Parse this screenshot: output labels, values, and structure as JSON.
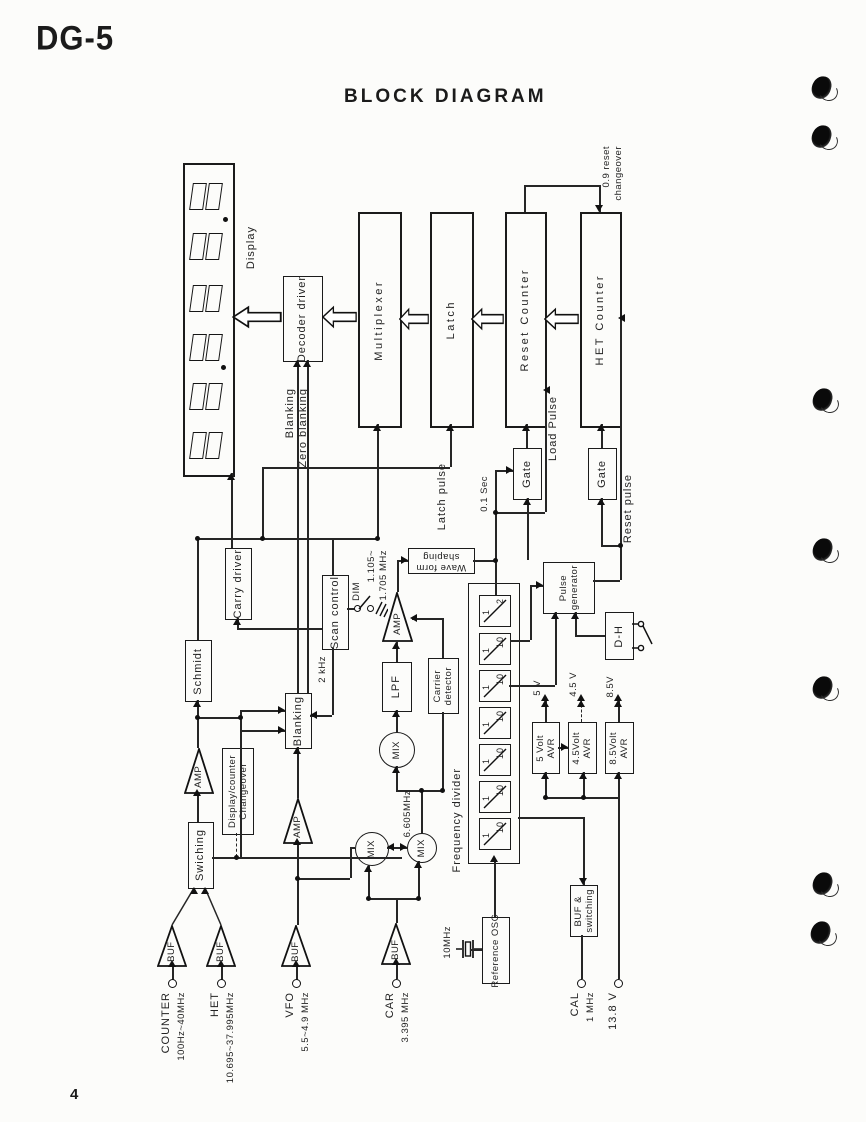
{
  "page": {
    "model": "DG-5",
    "title": "BLOCK DIAGRAM",
    "page_number": "4"
  },
  "blocks": {
    "display": "Display",
    "decoder_driver": "Decoder driver",
    "multiplexer": "Multiplexer",
    "latch": "Latch",
    "reset_counter": "Reset Counter",
    "het_counter": "HET Counter",
    "gate": "Gate",
    "carry_driver": "Carry driver",
    "scan_control": "Scan control",
    "schmidt": "Schmidt",
    "blanking": "Blanking",
    "swiching": "Swiching",
    "changeover": [
      "Display/counter",
      "Changeover"
    ],
    "wave_form_shaping": [
      "Wave form",
      "shaping"
    ],
    "pulse_generator": [
      "Pulse",
      "generator"
    ],
    "dh": "D-H",
    "lpf": "LPF",
    "carrier_detector": [
      "Carrier",
      "detector"
    ],
    "frequency_divider": "Frequency divider",
    "amp": "AMP",
    "buf": "BUF",
    "mix": "MIX",
    "avr5": [
      "5 Volt",
      "AVR"
    ],
    "avr45": [
      "4.5Volt",
      "AVR"
    ],
    "avr85": [
      "8.5Volt",
      "AVR"
    ],
    "buf_switching": [
      "BUF &",
      "switching"
    ],
    "reference_osc": "Reference OSC"
  },
  "divider_cells": [
    {
      "num": "1",
      "den": "2"
    },
    {
      "num": "1",
      "den": "10"
    },
    {
      "num": "1",
      "den": "10"
    },
    {
      "num": "1",
      "den": "10"
    },
    {
      "num": "1",
      "den": "10"
    },
    {
      "num": "1",
      "den": "10"
    },
    {
      "num": "1",
      "den": "10"
    }
  ],
  "wire_labels": {
    "blanking": "Blanking",
    "zero_blanking": "Zero blanking",
    "latch_pulse": "Latch pulse",
    "load_pulse": "Load Pulse",
    "sec_01": "0.1 Sec",
    "reset_pulse": "Reset pulse",
    "reset_changeover": [
      "0.9 reset",
      "changeover"
    ],
    "khz2": "2 kHz",
    "dim": "DIM",
    "mhz_1105": [
      "1.105~",
      "1.705 MHz"
    ],
    "mhz_6605": "6.605MHz",
    "mhz_10": "10MHz",
    "v5": "5 V",
    "v45": "4.5 V",
    "v85": "8.5V"
  },
  "terminals": {
    "counter": {
      "name": "COUNTER",
      "range": "100Hz~40MHz"
    },
    "het": {
      "name": "HET",
      "range": "10.695~37.995MHz"
    },
    "vfo": {
      "name": "VFO",
      "range": "5.5~4.9 MHz"
    },
    "car": {
      "name": "CAR",
      "range": "3.395 MHz"
    },
    "cal": {
      "name": "CAL",
      "range": "1 MHz"
    },
    "supply": {
      "name": "13.8 V"
    }
  }
}
